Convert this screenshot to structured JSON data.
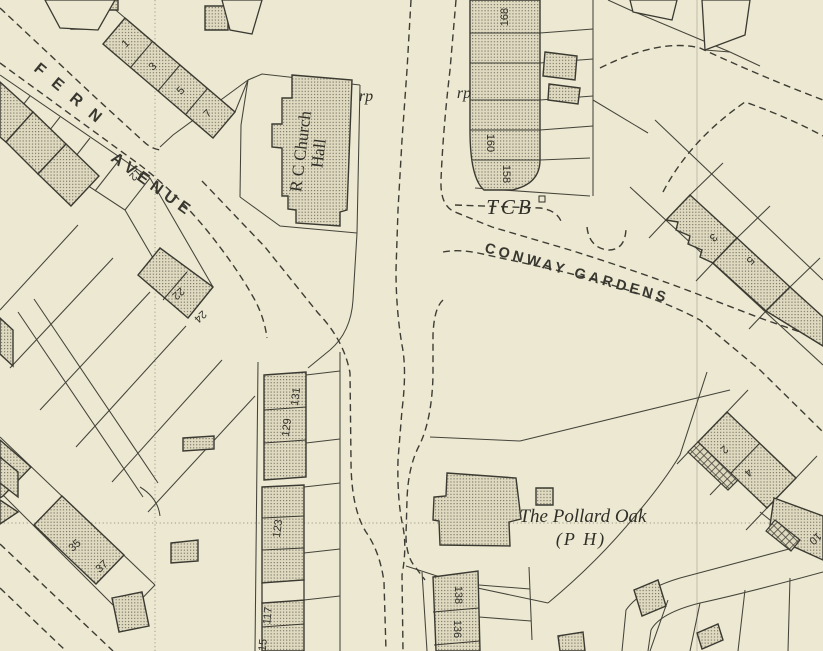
{
  "colors": {
    "paper": "#ece8d1",
    "ink": "#3b3a32",
    "building_fill": "#ded9bf",
    "grid_line": "#9b9884"
  },
  "streets": {
    "fern_word1": "FERN",
    "fern_word2": "AVENUE",
    "conway": "CONWAY GARDENS"
  },
  "places": {
    "church_hall_line1": "R C Church",
    "church_hall_line2": "Hall",
    "pub_name": "The Pollard Oak",
    "pub_type": "(P H)"
  },
  "markers": {
    "tcb": "TCB",
    "rp_west": "rp",
    "rp_east": "rp"
  },
  "house_numbers": {
    "fern_ne": [
      "1",
      "3",
      "5",
      "7"
    ],
    "fern_sw": [
      "12",
      "22",
      "24",
      "35",
      "37"
    ],
    "ne_terrace": [
      "168",
      "160",
      "158"
    ],
    "conway_terrace": [
      "3",
      "5"
    ],
    "center_terrace": [
      "131",
      "129",
      "123",
      "117",
      "115"
    ],
    "bottom_terrace": [
      "138",
      "136"
    ],
    "se_terrace": [
      "2",
      "4",
      "10"
    ]
  }
}
